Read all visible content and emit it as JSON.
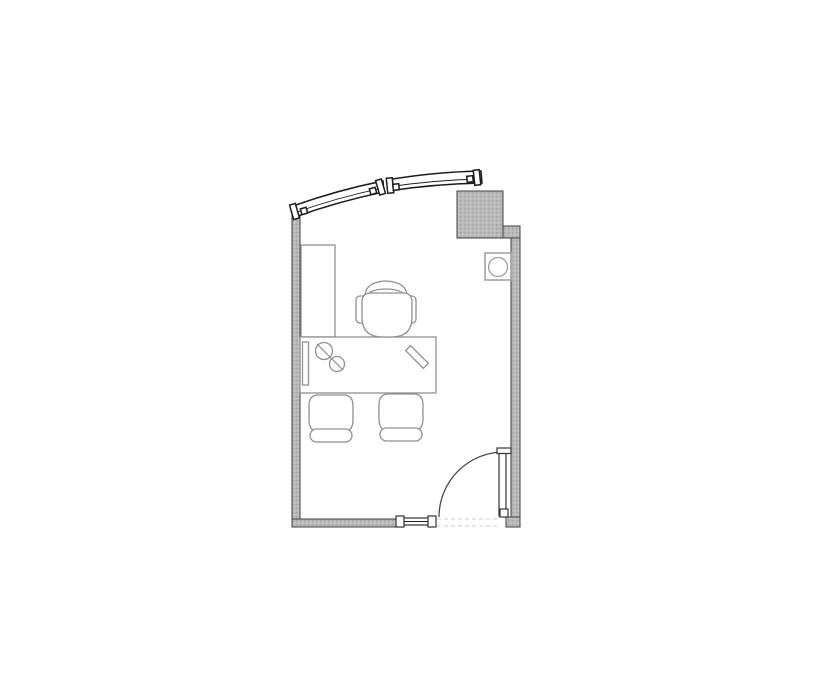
{
  "floor_plan": {
    "description": "Architectural floor plan of a single office room with a curved exterior window wall at top, a structural column at the top right, an equipment box fixture on the right wall, an L-shaped desk area with credenza and task chair, two guest chairs, a sidelight window in the bottom wall and an inward-swinging entry door at the bottom right",
    "colors": {
      "background": "#ffffff",
      "wall_fill": "#b9b9b9",
      "wall_stipple": "#a4a4a4",
      "wall_stipple_light": "#cccccc",
      "wall_outline": "#3f3f3f",
      "window_outline": "#1c1c1c",
      "furniture_line": "#909090",
      "door_line": "#4a4a4a",
      "door_leaf_outline": "#333333",
      "equipment_line": "#9e9e9e",
      "threshold_dash": "#d8cccc"
    },
    "elements": {
      "walls": [
        "left-wall",
        "bottom-wall",
        "right-wall",
        "wall-step",
        "column",
        "bottom-right-wall-stub"
      ],
      "windows": [
        "curved-window-segment-left",
        "curved-window-segment-right",
        "bottom-sidelight-window"
      ],
      "door": {
        "type": "single-swing",
        "hinge": "bottom-right",
        "swing": "opens-into-room"
      },
      "furniture": [
        "credenza",
        "desk",
        "desk-tray",
        "task-chair",
        "guest-chair-1",
        "guest-chair-2"
      ],
      "desk_items": [
        "phone-handset-symbol",
        "pen-symbol"
      ],
      "fixtures": [
        "equipment-box"
      ]
    }
  }
}
